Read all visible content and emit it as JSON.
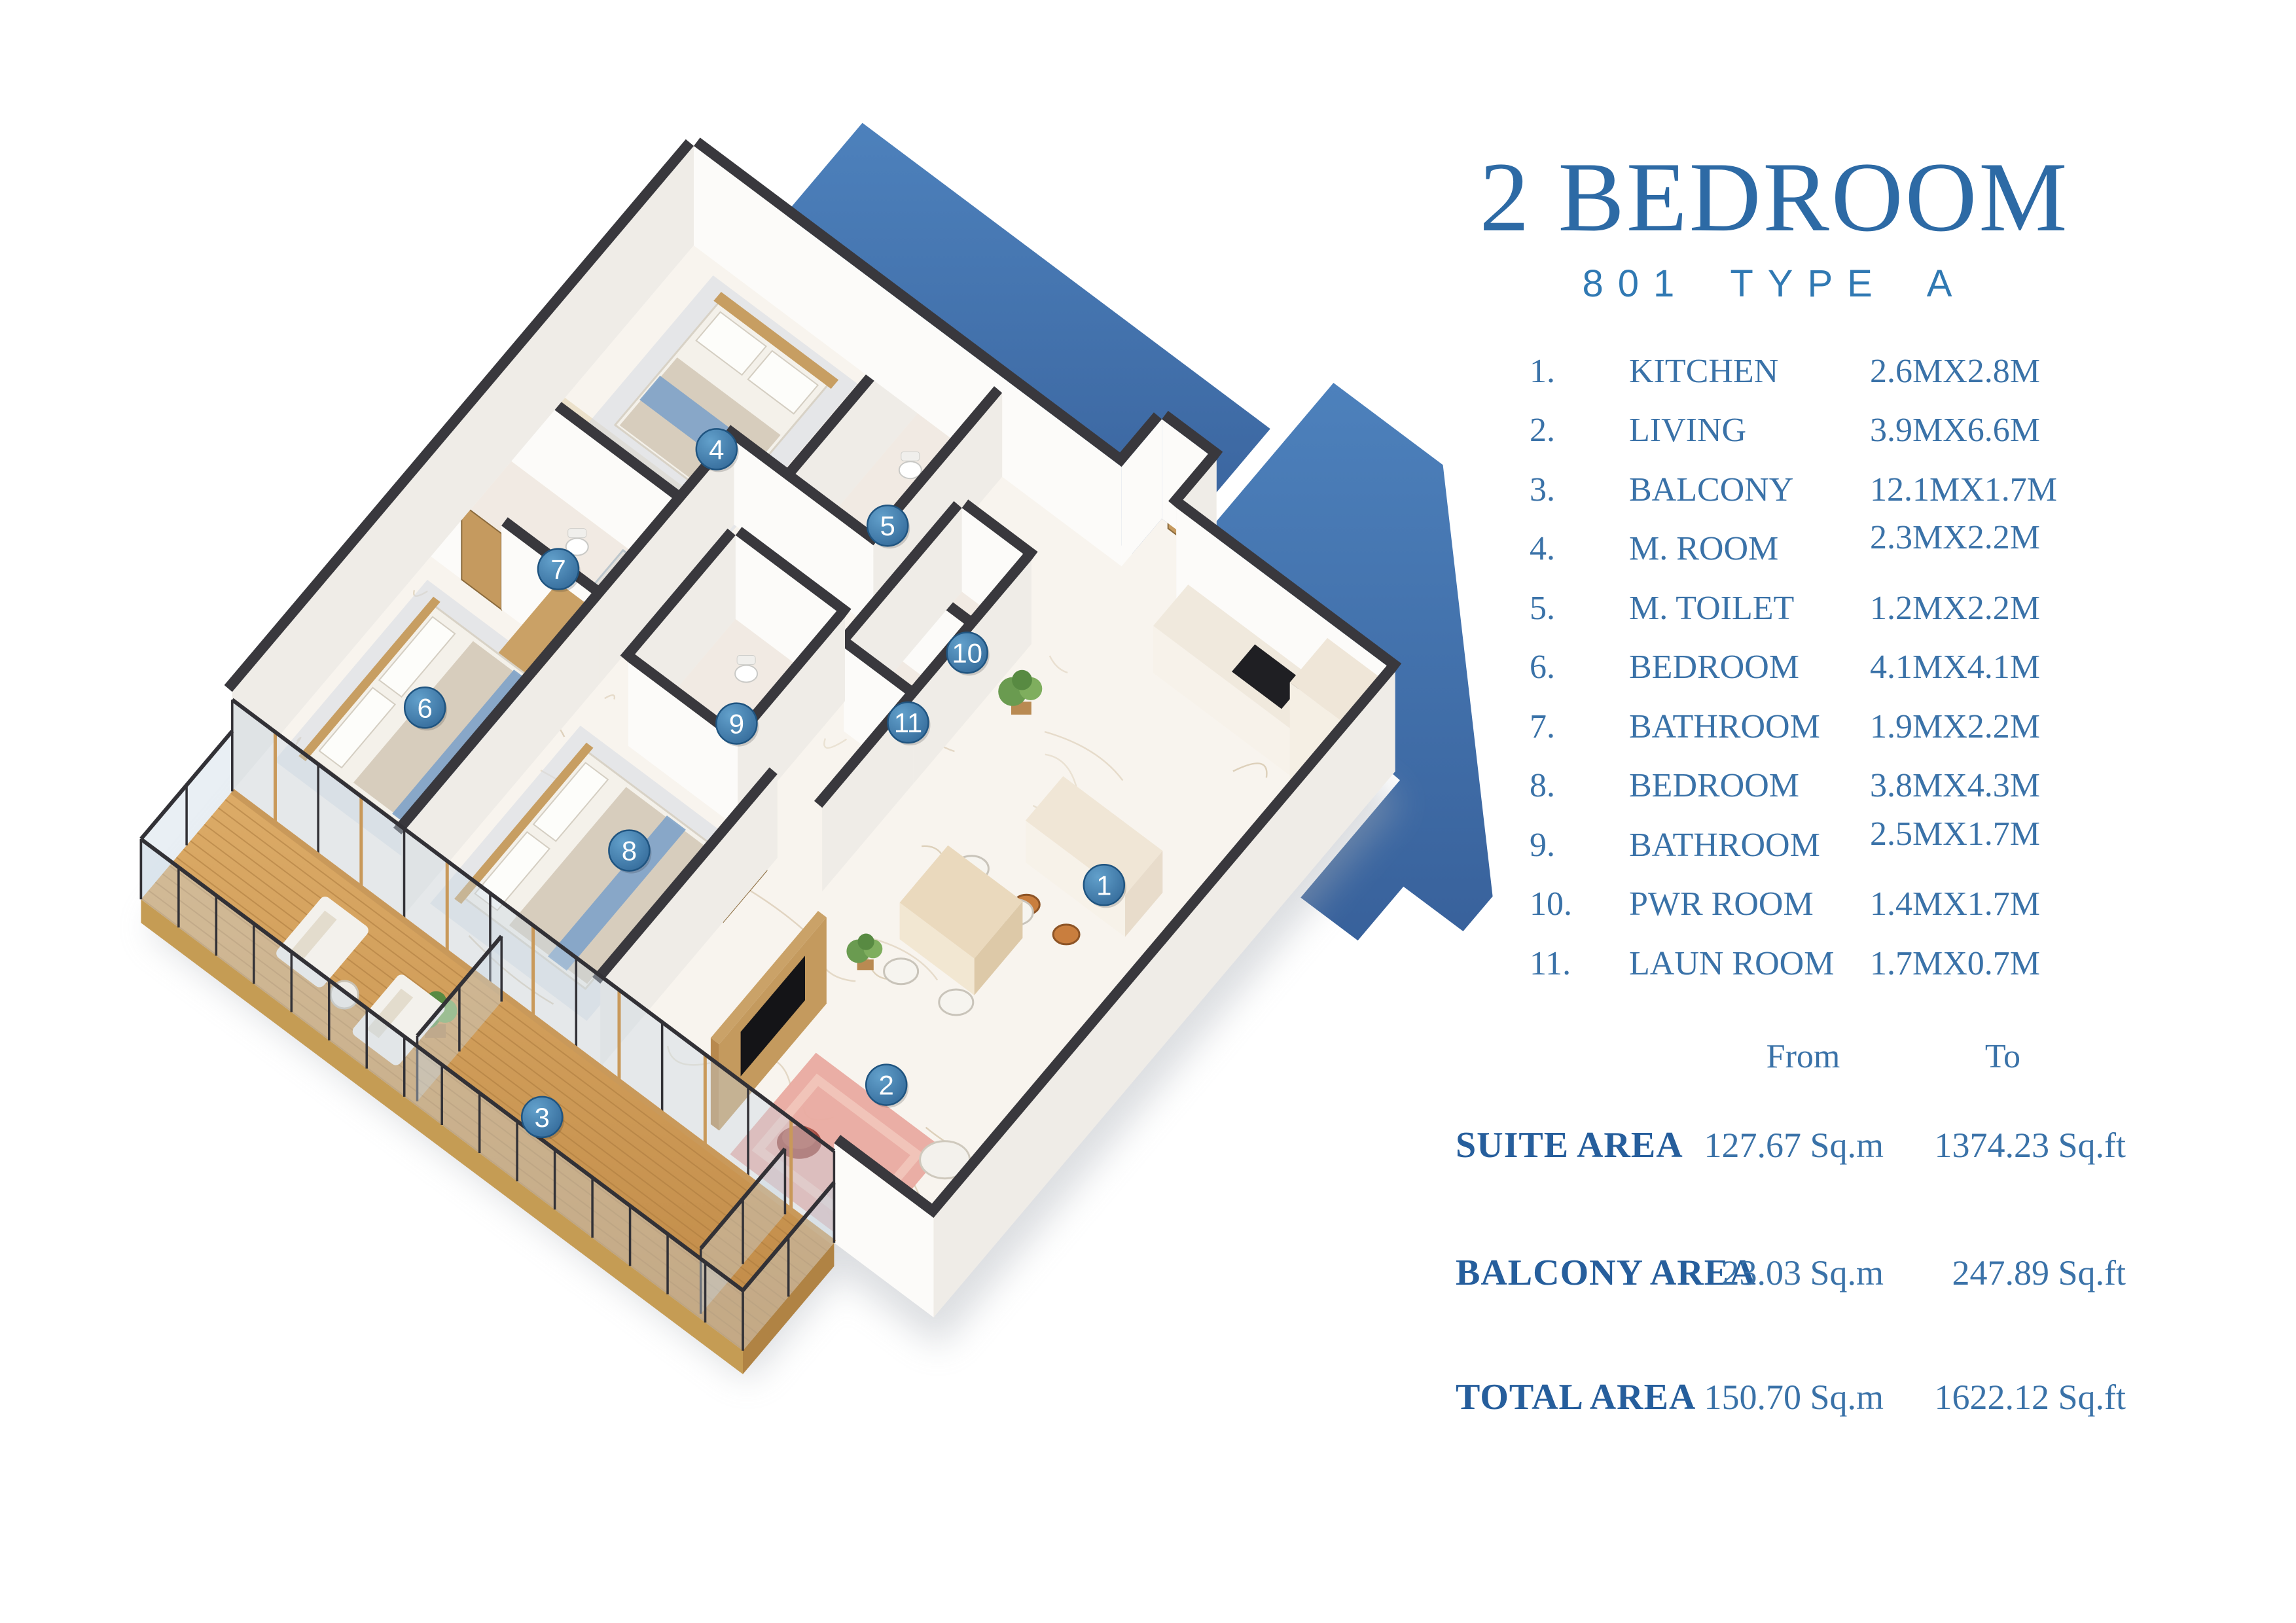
{
  "title": "2 BEDROOM",
  "subtitle": "801 TYPE A",
  "colors": {
    "accent": "#2d6aa5",
    "subtitle_blue": "#3079b3",
    "list_text": "#3a72a8",
    "backdrop_blue": "#4277b1",
    "marker_blue": "#3d7ba9",
    "wall_cap": "#39383d",
    "deck_wood": "#d2a05c"
  },
  "rooms": [
    {
      "no": "1.",
      "name": "KITCHEN",
      "dim": "2.6MX2.8M"
    },
    {
      "no": "2.",
      "name": "LIVING",
      "dim": "3.9MX6.6M"
    },
    {
      "no": "3.",
      "name": "BALCONY",
      "dim": "12.1MX1.7M"
    },
    {
      "no": "4.",
      "name": "M. ROOM",
      "dim": "2.3MX2.2M"
    },
    {
      "no": "5.",
      "name": "M. TOILET",
      "dim": "1.2MX2.2M"
    },
    {
      "no": "6.",
      "name": "BEDROOM",
      "dim": "4.1MX4.1M"
    },
    {
      "no": "7.",
      "name": "BATHROOM",
      "dim": "1.9MX2.2M"
    },
    {
      "no": "8.",
      "name": "BEDROOM",
      "dim": "3.8MX4.3M"
    },
    {
      "no": "9.",
      "name": "BATHROOM",
      "dim": "2.5MX1.7M"
    },
    {
      "no": "10.",
      "name": "PWR ROOM",
      "dim": "1.4MX1.7M"
    },
    {
      "no": "11.",
      "name": "LAUN ROOM",
      "dim": "1.7MX0.7M"
    }
  ],
  "area_table": {
    "col_from": "From",
    "col_to": "To",
    "rows": [
      {
        "label": "SUITE AREA",
        "from": "127.67 Sq.m",
        "to": "1374.23 Sq.ft"
      },
      {
        "label": "BALCONY AREA",
        "from": "23.03 Sq.m",
        "to": "247.89 Sq.ft"
      },
      {
        "label": "TOTAL AREA",
        "from": "150.70 Sq.m",
        "to": "1622.12 Sq.ft"
      }
    ]
  },
  "markers": [
    "1",
    "2",
    "3",
    "4",
    "5",
    "6",
    "7",
    "8",
    "9",
    "10",
    "11"
  ]
}
